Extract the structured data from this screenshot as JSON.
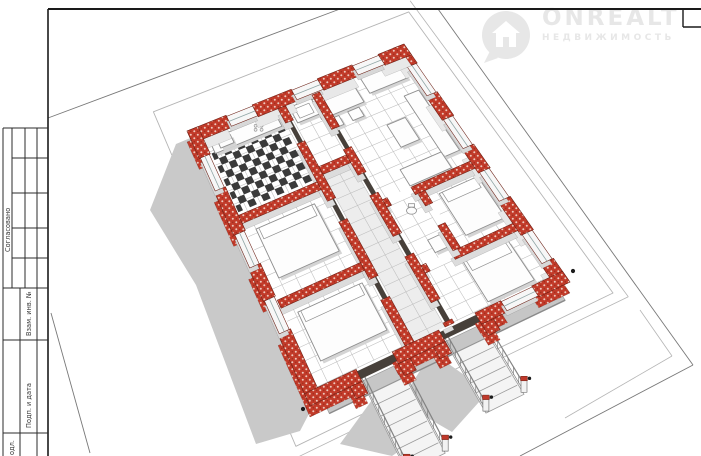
{
  "watermark": {
    "brand": "ONREALT",
    "subtitle": "НЕДВИЖИМОСТЬ",
    "icon": "house-pin-icon",
    "color": "#e7e7e7"
  },
  "title_block": {
    "soglasovano": "Согласовано",
    "vzam": "Взам. инв. №",
    "podp": "Подп. и дата",
    "inv_fragment": "одл."
  },
  "colors": {
    "frame": "#1a1a1a",
    "tbLine": "#2b2b2b",
    "brick": "#c23b2a",
    "brickStroke": "#6b1f14",
    "innerFace": "#e8e8e8",
    "faceGray": "#dcdcdc",
    "shadow": "#c9c9c9",
    "floorLine": "#bdbdbd",
    "corridorFill": "#ededed",
    "roomFill": "#ffffff",
    "furnStroke": "#8f8f8f",
    "furnFill": "#fdfdfd",
    "furnShadow": "#d4d4d4",
    "plotLine": "#787878",
    "eaves": "#b5b5b5",
    "glass": "#8fa5a5",
    "terrace": "#c6c6c6",
    "checkerDark": "#3a3a3a",
    "threshold": "#47403a",
    "postCap": "#c0392b",
    "sillTop": "#f7f7f7",
    "sillFace": "#d8d8d8",
    "stepLine": "#9a9a9a",
    "rail": "#828282",
    "dot": "#1c1c1c"
  },
  "floorplan": {
    "corners": {
      "n": [
        404,
        44
      ],
      "e": [
        570,
        282
      ],
      "s": [
        310,
        406
      ],
      "w": [
        187,
        131
      ]
    },
    "tile": {
      "du": 0.048,
      "dv": 0.06
    },
    "plot_lines": [
      [
        48,
        118,
        340,
        9
      ],
      [
        438,
        9,
        693,
        365
      ],
      [
        693,
        365,
        520,
        456
      ],
      [
        51,
        313,
        90,
        453
      ]
    ],
    "plot_lines_light": [
      [
        640,
        310,
        672,
        356
      ],
      [
        672,
        356,
        565,
        418
      ]
    ],
    "eaves": {
      "inset": 0.1,
      "fascia": 0.135
    },
    "shadow_poly": [
      [
        400,
        50
      ],
      [
        176,
        144
      ],
      [
        150,
        210
      ],
      [
        196,
        285
      ],
      [
        256,
        444
      ],
      [
        300,
        431
      ],
      [
        312,
        408
      ],
      [
        188,
        132
      ],
      [
        402,
        46
      ]
    ],
    "porch_shadows": [
      [
        [
          432,
          352
        ],
        [
          400,
          402
        ],
        [
          452,
          432
        ],
        [
          488,
          392
        ]
      ],
      [
        [
          372,
          400
        ],
        [
          340,
          444
        ],
        [
          392,
          456
        ],
        [
          430,
          430
        ]
      ]
    ],
    "terrace": {
      "u": [
        1.0,
        1.05
      ],
      "v": [
        0.05,
        0.95
      ]
    },
    "rooms": [
      {
        "id": "living",
        "u": [
          0.045,
          0.47
        ],
        "v": [
          0.045,
          0.42
        ],
        "fill": "room"
      },
      {
        "id": "bedroom-1",
        "u": [
          0.5,
          0.73
        ],
        "v": [
          0.045,
          0.26
        ],
        "fill": "room"
      },
      {
        "id": "wc",
        "u": [
          0.5,
          0.73
        ],
        "v": [
          0.29,
          0.42
        ],
        "fill": "room"
      },
      {
        "id": "bedroom-2",
        "u": [
          0.76,
          0.955
        ],
        "v": [
          0.045,
          0.42
        ],
        "fill": "room"
      },
      {
        "id": "bath",
        "u": [
          0.045,
          0.28
        ],
        "v": [
          0.455,
          0.575
        ],
        "fill": "room"
      },
      {
        "id": "corridor",
        "u": [
          0.31,
          0.955
        ],
        "v": [
          0.455,
          0.575
        ],
        "fill": "corridor"
      },
      {
        "id": "kitchen",
        "u": [
          0.045,
          0.325
        ],
        "v": [
          0.61,
          0.95
        ],
        "fill": "room"
      },
      {
        "id": "bedroom-3",
        "u": [
          0.355,
          0.635
        ],
        "v": [
          0.61,
          0.95
        ],
        "fill": "room"
      },
      {
        "id": "bedroom-4",
        "u": [
          0.665,
          0.955
        ],
        "v": [
          0.61,
          0.95
        ],
        "fill": "room"
      }
    ],
    "checker": {
      "u": [
        0.1,
        0.315
      ],
      "v": [
        0.625,
        0.945
      ],
      "du": 0.024,
      "dv": 0.03
    },
    "walls": [
      {
        "kind": "outer_back",
        "u": [
          0.0,
          0.08
        ],
        "v": [
          0.0,
          0.05
        ]
      },
      {
        "kind": "outer_back",
        "u": [
          0.2,
          0.3
        ],
        "v": [
          0.0,
          0.05
        ]
      },
      {
        "kind": "outer_back",
        "u": [
          0.42,
          0.52
        ],
        "v": [
          0.0,
          0.05
        ]
      },
      {
        "kind": "outer_back",
        "u": [
          0.64,
          0.78
        ],
        "v": [
          0.0,
          0.05
        ]
      },
      {
        "kind": "outer_back",
        "u": [
          0.9,
          1.0
        ],
        "v": [
          0.0,
          0.05
        ]
      },
      {
        "kind": "sill",
        "u": [
          0.08,
          0.2
        ],
        "v": [
          0.005,
          0.045
        ]
      },
      {
        "kind": "sill",
        "u": [
          0.3,
          0.42
        ],
        "v": [
          0.005,
          0.045
        ]
      },
      {
        "kind": "sill",
        "u": [
          0.52,
          0.64
        ],
        "v": [
          0.005,
          0.045
        ]
      },
      {
        "kind": "sill",
        "u": [
          0.78,
          0.9
        ],
        "v": [
          0.005,
          0.045
        ]
      },
      {
        "kind": "outer_back",
        "u": [
          0.0,
          0.045
        ],
        "v": [
          0.0,
          0.12
        ]
      },
      {
        "kind": "outer_back",
        "u": [
          0.0,
          0.045
        ],
        "v": [
          0.24,
          0.4
        ]
      },
      {
        "kind": "outer_back",
        "u": [
          0.0,
          0.045
        ],
        "v": [
          0.52,
          0.7
        ]
      },
      {
        "kind": "outer_back",
        "u": [
          0.0,
          0.045
        ],
        "v": [
          0.82,
          1.0
        ]
      },
      {
        "kind": "sill",
        "u": [
          0.004,
          0.041
        ],
        "v": [
          0.12,
          0.24
        ]
      },
      {
        "kind": "sill",
        "u": [
          0.004,
          0.041
        ],
        "v": [
          0.4,
          0.52
        ]
      },
      {
        "kind": "sill",
        "u": [
          0.004,
          0.041
        ],
        "v": [
          0.7,
          0.82
        ]
      },
      {
        "kind": "inner",
        "u": [
          0.47,
          0.5
        ],
        "v": [
          0.05,
          0.3
        ]
      },
      {
        "kind": "inner",
        "u": [
          0.47,
          0.5
        ],
        "v": [
          0.4,
          0.42
        ]
      },
      {
        "kind": "inner",
        "u": [
          0.73,
          0.76
        ],
        "v": [
          0.05,
          0.3
        ]
      },
      {
        "kind": "inner",
        "u": [
          0.73,
          0.76
        ],
        "v": [
          0.4,
          0.42
        ]
      },
      {
        "kind": "inner",
        "u": [
          0.5,
          0.55
        ],
        "v": [
          0.26,
          0.29
        ]
      },
      {
        "kind": "inner",
        "u": [
          0.63,
          0.73
        ],
        "v": [
          0.26,
          0.29
        ]
      },
      {
        "kind": "inner",
        "u": [
          0.045,
          0.18
        ],
        "v": [
          0.42,
          0.455
        ]
      },
      {
        "kind": "inner",
        "u": [
          0.26,
          0.36
        ],
        "v": [
          0.42,
          0.455
        ]
      },
      {
        "kind": "inner",
        "u": [
          0.44,
          0.6
        ],
        "v": [
          0.42,
          0.455
        ]
      },
      {
        "kind": "inner",
        "u": [
          0.68,
          0.86
        ],
        "v": [
          0.42,
          0.455
        ]
      },
      {
        "kind": "inner",
        "u": [
          0.94,
          0.955
        ],
        "v": [
          0.42,
          0.455
        ]
      },
      {
        "kind": "inner",
        "u": [
          0.28,
          0.31
        ],
        "v": [
          0.455,
          0.575
        ]
      },
      {
        "kind": "inner",
        "u": [
          0.045,
          0.1
        ],
        "v": [
          0.575,
          0.61
        ]
      },
      {
        "kind": "inner",
        "u": [
          0.18,
          0.4
        ],
        "v": [
          0.575,
          0.61
        ]
      },
      {
        "kind": "inner",
        "u": [
          0.48,
          0.7
        ],
        "v": [
          0.575,
          0.61
        ]
      },
      {
        "kind": "inner",
        "u": [
          0.78,
          0.955
        ],
        "v": [
          0.575,
          0.61
        ]
      },
      {
        "kind": "inner",
        "u": [
          0.325,
          0.355
        ],
        "v": [
          0.61,
          0.95
        ]
      },
      {
        "kind": "inner",
        "u": [
          0.635,
          0.665
        ],
        "v": [
          0.61,
          0.95
        ]
      },
      {
        "kind": "outer_front",
        "u": [
          0.0,
          0.1
        ],
        "v": [
          0.95,
          1.0
        ]
      },
      {
        "kind": "outer_front",
        "u": [
          0.22,
          0.38
        ],
        "v": [
          0.95,
          1.0
        ]
      },
      {
        "kind": "outer_front",
        "u": [
          0.5,
          0.62
        ],
        "v": [
          0.95,
          1.0
        ]
      },
      {
        "kind": "outer_front",
        "u": [
          0.74,
          1.0
        ],
        "v": [
          0.95,
          1.0
        ]
      },
      {
        "kind": "sill",
        "u": [
          0.1,
          0.22
        ],
        "v": [
          0.955,
          0.995
        ]
      },
      {
        "kind": "sill",
        "u": [
          0.38,
          0.5
        ],
        "v": [
          0.955,
          0.995
        ]
      },
      {
        "kind": "sill",
        "u": [
          0.62,
          0.74
        ],
        "v": [
          0.955,
          0.995
        ]
      },
      {
        "kind": "outer_front",
        "u": [
          0.955,
          1.0
        ],
        "v": [
          0.0,
          0.12
        ]
      },
      {
        "kind": "outer_front",
        "u": [
          0.955,
          1.0
        ],
        "v": [
          0.24,
          0.34
        ]
      },
      {
        "kind": "outer_front",
        "u": [
          0.955,
          1.0
        ],
        "v": [
          0.48,
          0.66
        ]
      },
      {
        "kind": "outer_front",
        "u": [
          0.955,
          1.0
        ],
        "v": [
          0.8,
          1.0
        ]
      },
      {
        "kind": "sill",
        "u": [
          0.959,
          0.996
        ],
        "v": [
          0.12,
          0.24
        ]
      },
      {
        "kind": "stub",
        "u": [
          1.0,
          1.045
        ],
        "v": [
          0.295,
          0.34
        ]
      },
      {
        "kind": "stub",
        "u": [
          1.0,
          1.045
        ],
        "v": [
          0.48,
          0.525
        ]
      },
      {
        "kind": "stub",
        "u": [
          1.0,
          1.045
        ],
        "v": [
          0.615,
          0.66
        ]
      },
      {
        "kind": "stub",
        "u": [
          1.0,
          1.045
        ],
        "v": [
          0.8,
          0.845
        ]
      }
    ],
    "thresholds": [
      {
        "u": [
          0.18,
          0.26
        ],
        "v": [
          0.428,
          0.447
        ]
      },
      {
        "u": [
          0.36,
          0.44
        ],
        "v": [
          0.428,
          0.447
        ]
      },
      {
        "u": [
          0.6,
          0.68
        ],
        "v": [
          0.428,
          0.447
        ]
      },
      {
        "u": [
          0.86,
          0.94
        ],
        "v": [
          0.428,
          0.447
        ]
      },
      {
        "u": [
          0.1,
          0.18
        ],
        "v": [
          0.583,
          0.602
        ]
      },
      {
        "u": [
          0.4,
          0.48
        ],
        "v": [
          0.583,
          0.602
        ]
      },
      {
        "u": [
          0.7,
          0.78
        ],
        "v": [
          0.583,
          0.602
        ]
      },
      {
        "u": [
          0.963,
          0.992
        ],
        "v": [
          0.34,
          0.48
        ]
      },
      {
        "u": [
          0.963,
          0.992
        ],
        "v": [
          0.66,
          0.8
        ]
      }
    ],
    "furniture": [
      {
        "id": "sofa-main",
        "type": "rect",
        "u": [
          0.17,
          0.42
        ],
        "v": [
          0.06,
          0.125
        ]
      },
      {
        "id": "sofa-side",
        "type": "rect",
        "u": [
          0.4,
          0.465
        ],
        "v": [
          0.125,
          0.3
        ]
      },
      {
        "id": "coffee-table",
        "type": "rect",
        "u": [
          0.24,
          0.33
        ],
        "v": [
          0.17,
          0.25
        ]
      },
      {
        "id": "dining-table",
        "type": "rect",
        "u": [
          0.06,
          0.135
        ],
        "v": [
          0.28,
          0.47
        ]
      },
      {
        "id": "chair",
        "type": "rect",
        "u": [
          0.03,
          0.065
        ],
        "v": [
          0.31,
          0.36
        ]
      },
      {
        "id": "chair",
        "type": "rect",
        "u": [
          0.03,
          0.065
        ],
        "v": [
          0.4,
          0.45
        ]
      },
      {
        "id": "chair",
        "type": "rect",
        "u": [
          0.145,
          0.18
        ],
        "v": [
          0.31,
          0.36
        ]
      },
      {
        "id": "chair",
        "type": "rect",
        "u": [
          0.145,
          0.18
        ],
        "v": [
          0.4,
          0.45
        ]
      },
      {
        "id": "wardrobe",
        "type": "rect",
        "u": [
          0.055,
          0.115
        ],
        "v": [
          0.07,
          0.24
        ]
      },
      {
        "id": "bed-1",
        "type": "bed",
        "u": [
          0.53,
          0.7
        ],
        "v": [
          0.06,
          0.22
        ],
        "pu": [
          0.53,
          0.57
        ]
      },
      {
        "id": "bed-2",
        "type": "bed",
        "u": [
          0.78,
          0.94
        ],
        "v": [
          0.1,
          0.28
        ],
        "pu": [
          0.78,
          0.82
        ]
      },
      {
        "id": "bed-3",
        "type": "bed",
        "u": [
          0.39,
          0.57
        ],
        "v": [
          0.66,
          0.91
        ],
        "pu": [
          0.39,
          0.43
        ]
      },
      {
        "id": "bed-4",
        "type": "bed",
        "u": [
          0.7,
          0.88
        ],
        "v": [
          0.64,
          0.9
        ],
        "pu": [
          0.7,
          0.74
        ]
      },
      {
        "id": "bathtub",
        "type": "tub",
        "u": [
          0.055,
          0.115
        ],
        "v": [
          0.465,
          0.565
        ]
      },
      {
        "id": "wc-sink",
        "type": "rect",
        "u": [
          0.66,
          0.71
        ],
        "v": [
          0.3,
          0.35
        ]
      },
      {
        "id": "wc-toilet",
        "type": "toilet",
        "at": [
          0.545,
          0.345
        ]
      },
      {
        "id": "kitchen-counter",
        "type": "rect",
        "u": [
          0.055,
          0.105
        ],
        "v": [
          0.63,
          0.93
        ]
      },
      {
        "id": "kitchen-sink",
        "type": "rect",
        "u": [
          0.065,
          0.095
        ],
        "v": [
          0.84,
          0.9
        ]
      },
      {
        "id": "stove",
        "type": "dots",
        "at": [
          0.08,
          0.72
        ]
      }
    ],
    "porches": [
      {
        "v": [
          0.34,
          0.48
        ],
        "uEnd": 1.28,
        "steps": 5
      },
      {
        "v": [
          0.66,
          0.8
        ],
        "uEnd": 1.34,
        "steps": 6
      }
    ],
    "corner_dots": [
      [
        573,
        271
      ],
      [
        303,
        409
      ]
    ]
  },
  "frame": {
    "top_y": 9,
    "left_x": 48,
    "corner_box": {
      "x": 683,
      "y2": 27
    }
  }
}
